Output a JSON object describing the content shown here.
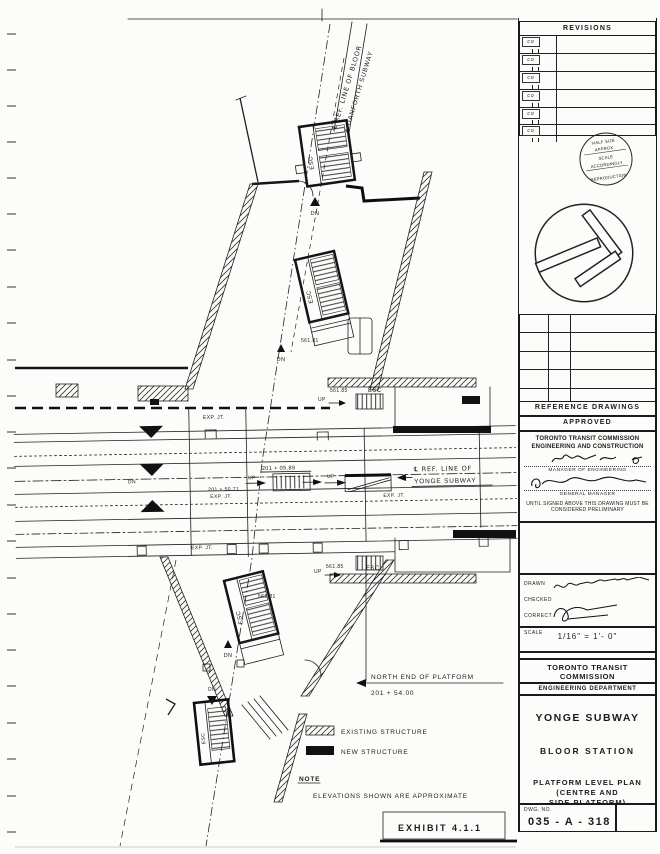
{
  "plan": {
    "labels": {
      "bloor_ref_1": "℄ REF. LINE OF BLOOR",
      "bloor_ref_2": "& DANFORTH SUBWAY",
      "yonge_ref_1": "℄ REF. LINE OF",
      "yonge_ref_2": "YONGE SUBWAY",
      "north_end_1": "NORTH END OF PLATFORM",
      "north_end_2": "201 + 54.00",
      "esc": "ESC",
      "dn": "DN",
      "up": "UP",
      "exp_jt": "EXP. JT.",
      "elev_561_81": "561.81",
      "elev_561_85": "561.85",
      "sta_201_05_89": "201 + 05.89",
      "sta_201_50_71": "201 + 50.71"
    },
    "legend": {
      "existing": "EXISTING STRUCTURE",
      "new": "NEW STRUCTURE",
      "note_label": "NOTE",
      "note_text": "ELEVATIONS SHOWN ARE APPROXIMATE",
      "exhibit": "EXHIBIT 4.1.1"
    }
  },
  "title_block": {
    "revisions_title": "REVISIONS",
    "revision_mark": "co",
    "stamp": {
      "l1": "HALF SIZE",
      "l2": "APPROX.",
      "l3": "SCALE",
      "l4": "ACCORDINGLY",
      "l5": "REPRODUCTION"
    },
    "reference_drawings": "REFERENCE DRAWINGS",
    "approved": {
      "title": "APPROVED",
      "org1": "TORONTO TRANSIT COMMISSION",
      "org2": "ENGINEERING AND CONSTRUCTION",
      "role1": "MANAGER OF ENGINEERING",
      "role2": "GENERAL MANAGER",
      "disclaimer1": "UNTIL SIGNED ABOVE THIS DRAWING MUST BE",
      "disclaimer2": "CONSIDERED PRELIMINARY"
    },
    "drawn_label": "DRAWN",
    "checked_label": "CHECKED",
    "correct_label": "CORRECT",
    "scale_label": "SCALE",
    "scale_value": "1/16\" = 1'- 0\"",
    "org_line1": "TORONTO TRANSIT",
    "org_line2": "COMMISSION",
    "dept": "ENGINEERING DEPARTMENT",
    "title_line1": "YONGE SUBWAY",
    "title_line2": "BLOOR STATION",
    "title_line3": "PLATFORM LEVEL PLAN",
    "title_line4": "(CENTRE AND",
    "title_line5": "SIDE PLATFORM)",
    "dwg_no_label": "DWG. NO.",
    "dwg_no": "035 - A - 318"
  }
}
